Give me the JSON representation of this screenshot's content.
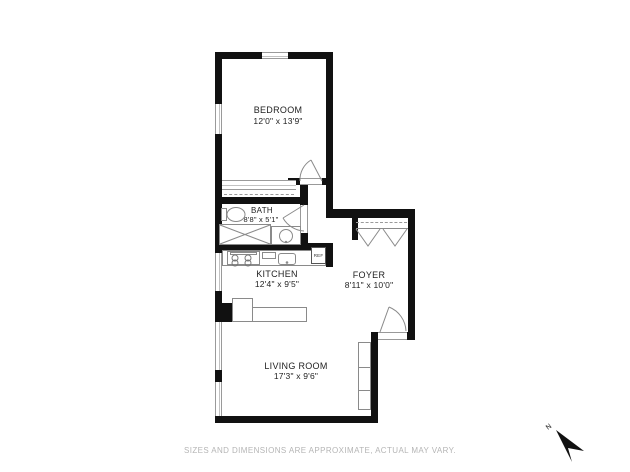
{
  "plan": {
    "rooms": {
      "bedroom": {
        "name": "BEDROOM",
        "dims": "12'0\" x 13'9\""
      },
      "bath": {
        "name": "BATH",
        "dims": "8'8\" x 5'1\""
      },
      "kitchen": {
        "name": "KITCHEN",
        "dims": "12'4\" x 9'5\""
      },
      "foyer": {
        "name": "FOYER",
        "dims": "8'11\" x 10'0\""
      },
      "living_room": {
        "name": "LIVING ROOM",
        "dims": "17'3\" x 9'6\""
      }
    },
    "labels": {
      "refrigerator": "REF"
    },
    "compass": {
      "north_label": "N"
    }
  },
  "footer": {
    "disclaimer": "SIZES AND DIMENSIONS ARE APPROXIMATE, ACTUAL MAY VARY."
  },
  "colors": {
    "wall": "#111111",
    "fixture_line": "#8a8a8a",
    "room_text": "#222222",
    "disclaimer_text": "#b5b5b5"
  }
}
